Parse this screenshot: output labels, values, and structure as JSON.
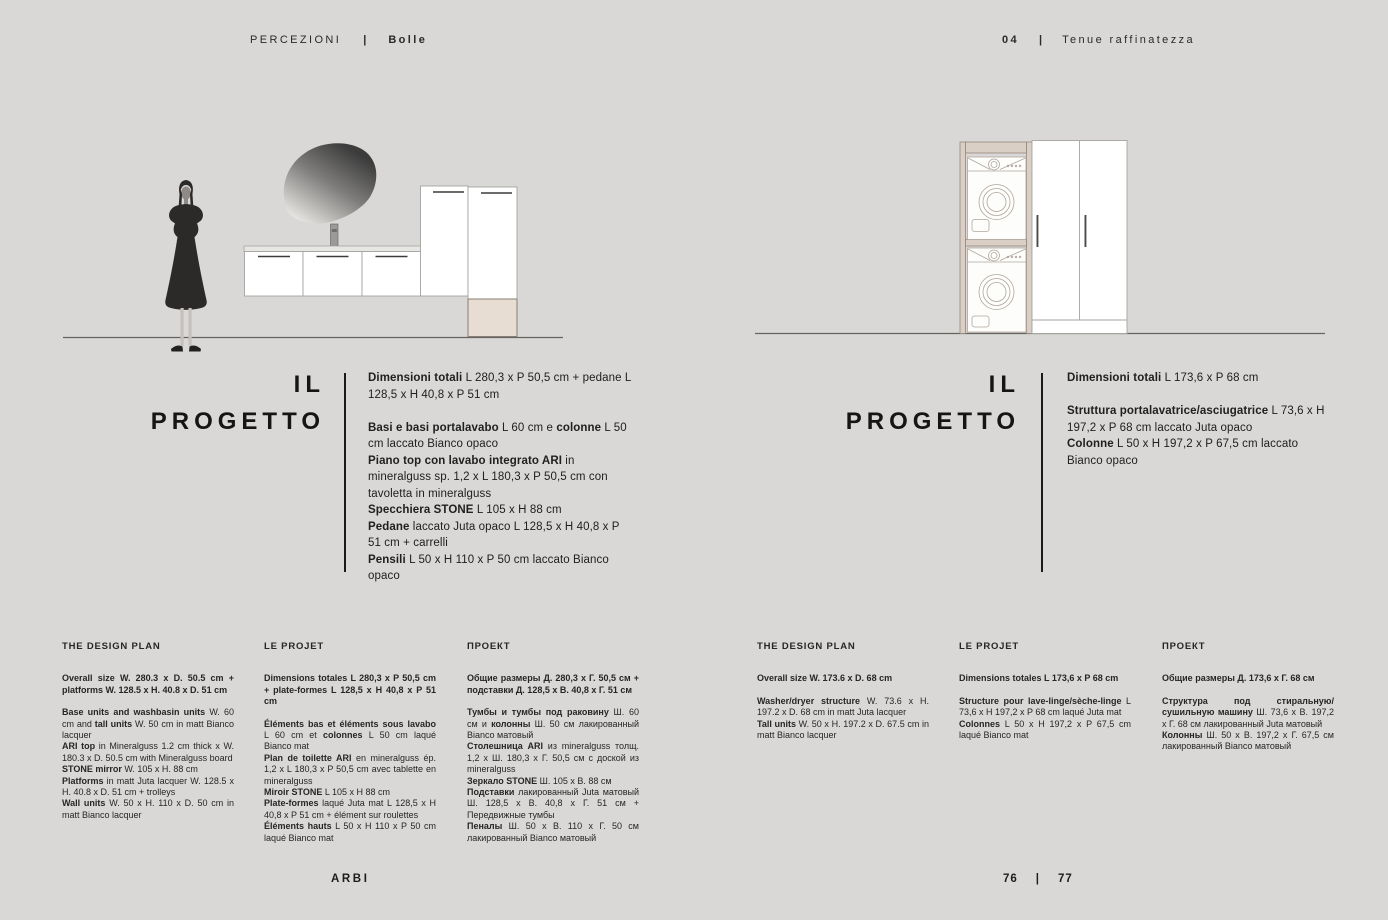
{
  "palette": {
    "background": "#d9d8d6",
    "text": "#1c1c1c",
    "juta_beige": "#e8ddd3",
    "frame_beige": "#d9cfc5",
    "cabinet_white": "#ffffff",
    "outline_gray": "#a3a3a1"
  },
  "header": {
    "collection": "PERCEZIONI",
    "divider": "|",
    "model": "Bolle",
    "chapter_number": "04",
    "chapter_title": "Tenue raffinatezza"
  },
  "drawings": {
    "left": {
      "label": "vanity-composition-elevation",
      "elements": [
        "scale-figure",
        "stone-mirror",
        "faucet",
        "washbasin-top",
        "base-units",
        "tall-units",
        "juta-platform",
        "ground-line"
      ]
    },
    "right": {
      "label": "laundry-composition-elevation",
      "elements": [
        "washer-dryer-frame",
        "washing-machine-upper",
        "washing-machine-lower",
        "tall-units",
        "door-handles",
        "ground-line"
      ]
    }
  },
  "pages": {
    "left": {
      "project": {
        "heading_line1": "IL",
        "heading_line2": "PROGETTO",
        "paragraphs": [
          [
            {
              "t": "Dimensioni totali",
              "b": true
            },
            {
              "t": " L 280,3 x P 50,5 cm + pedane L 128,5 x H 40,8 x P 51 cm"
            }
          ],
          [
            {
              "t": "Basi e basi portalavabo",
              "b": true
            },
            {
              "t": " L 60 cm e "
            },
            {
              "t": "colonne",
              "b": true
            },
            {
              "t": " L 50 cm laccato Bianco opaco"
            }
          ],
          [
            {
              "t": "Piano top con lavabo integrato ARI",
              "b": true
            },
            {
              "t": " in mineralguss sp. 1,2 x L 180,3 x P 50,5 cm con tavoletta in mineralguss"
            }
          ],
          [
            {
              "t": "Specchiera STONE",
              "b": true
            },
            {
              "t": " L 105 x H 88 cm"
            }
          ],
          [
            {
              "t": "Pedane",
              "b": true
            },
            {
              "t": " laccato Juta opaco L 128,5 x H 40,8 x P 51 cm + carrelli"
            }
          ],
          [
            {
              "t": "Pensili",
              "b": true
            },
            {
              "t": " L 50 x H 110 x P 50 cm laccato Bianco opaco"
            }
          ]
        ]
      },
      "columns": {
        "en": {
          "heading": "THE DESIGN PLAN",
          "intro": [
            {
              "t": "Overall size W. 280.3 x D. 50.5 cm + platforms W. 128.5 x H. 40.8 x D. 51 cm",
              "b": true
            }
          ],
          "body": [
            [
              {
                "t": "Base units and washbasin units",
                "b": true
              },
              {
                "t": " W. 60 cm and "
              },
              {
                "t": "tall units",
                "b": true
              },
              {
                "t": " W. 50 cm in matt Bianco lacquer"
              }
            ],
            [
              {
                "t": "ARI top",
                "b": true
              },
              {
                "t": " in Mineralguss 1.2 cm thick x W. 180.3 x D. 50.5 cm with Mineralguss board"
              }
            ],
            [
              {
                "t": "STONE mirror",
                "b": true
              },
              {
                "t": " W. 105 x H. 88 cm"
              }
            ],
            [
              {
                "t": "Platforms",
                "b": true
              },
              {
                "t": " in matt Juta lacquer W. 128.5 x H. 40.8 x D. 51 cm + trolleys"
              }
            ],
            [
              {
                "t": "Wall units",
                "b": true
              },
              {
                "t": " W. 50 x H. 110 x D. 50 cm in matt Bianco lacquer"
              }
            ]
          ]
        },
        "fr": {
          "heading": "LE PROJET",
          "intro": [
            {
              "t": "Dimensions totales L 280,3 x P 50,5 cm + plate-formes L 128,5 x H 40,8 x P 51 cm",
              "b": true
            }
          ],
          "body": [
            [
              {
                "t": "Éléments bas et éléments sous lavabo",
                "b": true
              },
              {
                "t": " L 60 cm et "
              },
              {
                "t": "colonnes",
                "b": true
              },
              {
                "t": " L 50 cm laqué Bianco mat"
              }
            ],
            [
              {
                "t": "Plan de toilette ARI",
                "b": true
              },
              {
                "t": " en mineralguss ép. 1,2 x L 180,3 x P 50,5 cm avec tablette en mineralguss"
              }
            ],
            [
              {
                "t": "Miroir STONE",
                "b": true
              },
              {
                "t": " L 105 x H 88 cm"
              }
            ],
            [
              {
                "t": "Plate-formes",
                "b": true
              },
              {
                "t": " laqué Juta mat L 128,5 x H 40,8 x P 51 cm + élément sur roulettes"
              }
            ],
            [
              {
                "t": "Éléments hauts",
                "b": true
              },
              {
                "t": " L 50 x H 110 x P 50 cm laqué Bianco mat"
              }
            ]
          ]
        },
        "ru": {
          "heading": "ПРОЕКТ",
          "intro": [
            {
              "t": "Общие размеры Д. 280,3 х Г. 50,5 см + подставки Д. 128,5 х В. 40,8 х Г. 51 см",
              "b": true
            }
          ],
          "body": [
            [
              {
                "t": "Тумбы и тумбы под раковину",
                "b": true
              },
              {
                "t": " Ш. 60 см и "
              },
              {
                "t": "колонны",
                "b": true
              },
              {
                "t": " Ш. 50 см лакированный Bianco матовый"
              }
            ],
            [
              {
                "t": "Столешница ARI",
                "b": true
              },
              {
                "t": " из mineralguss толщ. 1,2 х Ш. 180,3 х Г. 50,5 см с доской из mineralguss"
              }
            ],
            [
              {
                "t": "Зеркало STONE",
                "b": true
              },
              {
                "t": " Ш. 105 х В. 88 см"
              }
            ],
            [
              {
                "t": "Подставки",
                "b": true
              },
              {
                "t": " лакированный Juta матовый Ш. 128,5 х В. 40,8 х Г. 51 см + Передвижные тумбы"
              }
            ],
            [
              {
                "t": "Пеналы",
                "b": true
              },
              {
                "t": " Ш. 50 х В. 110 х Г. 50 см лакированный Bianco матовый"
              }
            ]
          ]
        }
      }
    },
    "right": {
      "project": {
        "heading_line1": "IL",
        "heading_line2": "PROGETTO",
        "paragraphs": [
          [
            {
              "t": "Dimensioni totali",
              "b": true
            },
            {
              "t": " L 173,6 x P 68 cm"
            }
          ],
          [
            {
              "t": "Struttura portalavatrice/asciugatrice",
              "b": true
            },
            {
              "t": " L 73,6 x H 197,2 x P 68 cm laccato Juta opaco"
            }
          ],
          [
            {
              "t": "Colonne",
              "b": true
            },
            {
              "t": " L 50 x H 197,2 x P 67,5 cm laccato Bianco opaco"
            }
          ]
        ]
      },
      "columns": {
        "en": {
          "heading": "THE DESIGN PLAN",
          "intro": [
            {
              "t": "Overall size W. 173.6 x D. 68 cm",
              "b": true
            }
          ],
          "body": [
            [
              {
                "t": "Washer/dryer structure",
                "b": true
              },
              {
                "t": " W. 73.6 x H. 197.2 x D. 68 cm in matt Juta lacquer"
              }
            ],
            [
              {
                "t": "Tall units",
                "b": true
              },
              {
                "t": " W. 50 x H. 197.2 x D. 67.5 cm in matt Bianco lacquer"
              }
            ]
          ]
        },
        "fr": {
          "heading": "LE PROJET",
          "intro": [
            {
              "t": "Dimensions totales L 173,6 x P 68 cm",
              "b": true
            }
          ],
          "body": [
            [
              {
                "t": "Structure pour lave-linge/sèche-linge",
                "b": true
              },
              {
                "t": " L 73,6 x H 197,2 x P 68 cm laqué Juta mat"
              }
            ],
            [
              {
                "t": "Colonnes",
                "b": true
              },
              {
                "t": " L 50 x H 197,2 x P 67,5 cm laqué Bianco mat"
              }
            ]
          ]
        },
        "ru": {
          "heading": "ПРОЕКТ",
          "intro": [
            {
              "t": "Общие размеры Д. 173,6 х Г. 68 см",
              "b": true
            }
          ],
          "body": [
            [
              {
                "t": "Структура под стиральную/сушильную машину",
                "b": true
              },
              {
                "t": " Ш. 73,6 х В. 197,2 х Г. 68 см лакированный Juta матовый"
              }
            ],
            [
              {
                "t": "Колонны",
                "b": true
              },
              {
                "t": " Ш. 50 х В. 197,2 х Г. 67,5 см лакированный Bianco матовый"
              }
            ]
          ]
        }
      }
    }
  },
  "footer": {
    "brand": "ARBI",
    "page_left": "76",
    "divider": "|",
    "page_right": "77"
  }
}
